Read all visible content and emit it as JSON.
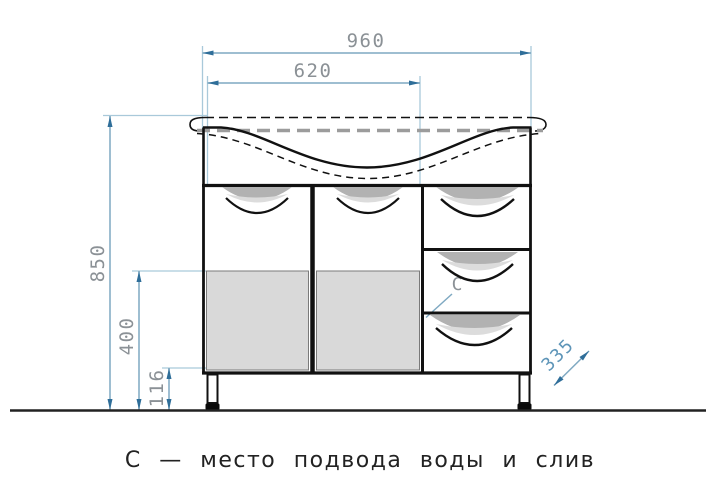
{
  "drawing": {
    "title": "vanity-cabinet-front-elevation",
    "caption": "С — место подвода воды и слив",
    "labels": {
      "connection_point": "С"
    },
    "dimensions": {
      "overall_width_mm": "960",
      "doors_section_width_mm": "620",
      "overall_height_mm": "850",
      "lower_panel_height_mm": "400",
      "legs_height_mm": "116",
      "depth_mm": "335"
    },
    "colors": {
      "dimension_line": "#7fa9c2",
      "extension_line": "#a9c9da",
      "arrow": "#2f6e99",
      "dimension_text": "#8b9196",
      "depth_text": "#5e95b8",
      "drawing_line": "#111111",
      "panel_fill": "#d9d9d9",
      "handle_recess_fill": "#b2b2b2",
      "caption_text": "#222222"
    }
  }
}
